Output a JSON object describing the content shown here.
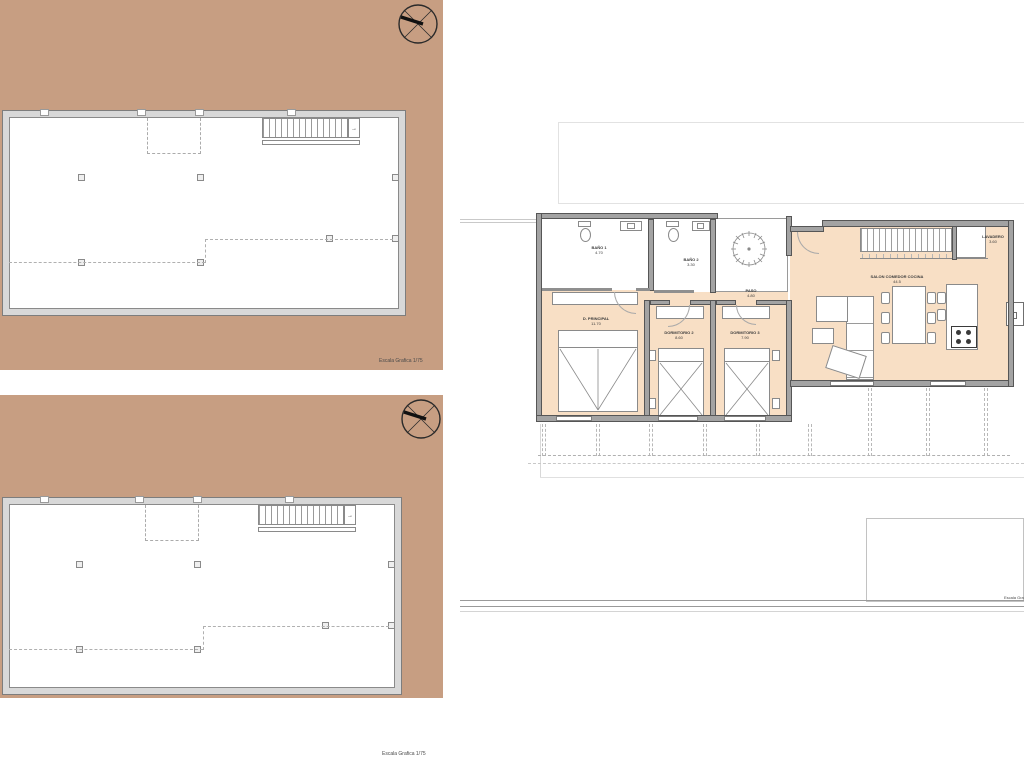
{
  "colors": {
    "site_tan": "#c79e82",
    "floor_peach": "#f8dfc5",
    "wall_gray": "#a3a3a3",
    "wall_edge": "#565656",
    "line_light": "#c9c9c9"
  },
  "icons": {
    "north_arrow": "compass-north-arrow",
    "tree": "patio-tree",
    "stair_arrow": "→"
  },
  "panel_top_left": {
    "scale_label": "Escala Grafica 1/75"
  },
  "panel_bottom_left": {
    "scale_label": "Escala Grafica 1/75"
  },
  "panel_right": {
    "scale_label": "Escala Grafica 1/75"
  },
  "rooms": {
    "bano1": {
      "name": "BAÑO 1",
      "area": "4.70"
    },
    "bano2": {
      "name": "BAÑO 2",
      "area": "3.30"
    },
    "principal": {
      "name": "D. PRINCIPAL",
      "area": "11.70"
    },
    "dorm2": {
      "name": "DORMITORIO 2",
      "area": "8.60"
    },
    "dorm3": {
      "name": "DORMITORIO 3",
      "area": "7.90"
    },
    "paso": {
      "name": "PASO",
      "area": "4.80"
    },
    "salon": {
      "name": "SALON COMEDOR COCINA",
      "area": "44.5"
    },
    "lavadero": {
      "name": "LAVADERO",
      "area": "3.60"
    }
  }
}
